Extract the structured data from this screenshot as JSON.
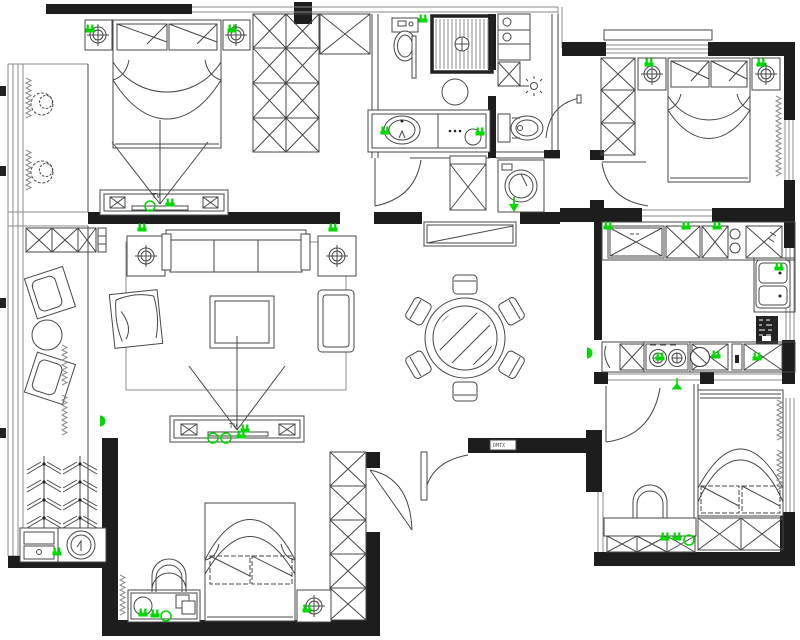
{
  "document": {
    "kind": "apartment-floor-plan",
    "style": "cad-line-drawing"
  },
  "labels": {
    "tv": "TV",
    "entry_wall_tag": "DMTX"
  },
  "colors": {
    "wall": "#1d1d1d",
    "line": "#474747",
    "marker": "#00d900",
    "background": "#ffffff"
  },
  "rooms": [
    {
      "id": "bedroom-top-left"
    },
    {
      "id": "walkin-wardrobe"
    },
    {
      "id": "bathroom-main"
    },
    {
      "id": "bathroom-second"
    },
    {
      "id": "bedroom-top-right"
    },
    {
      "id": "balcony-left"
    },
    {
      "id": "living-room"
    },
    {
      "id": "dining-room"
    },
    {
      "id": "kitchen"
    },
    {
      "id": "laundry-balcony"
    },
    {
      "id": "bedroom-bottom-middle"
    },
    {
      "id": "entry-hall"
    },
    {
      "id": "study-bottom-right"
    },
    {
      "id": "bedroom-bottom-right"
    }
  ],
  "markers": [
    {
      "k": "socket",
      "x": 90,
      "y": 30
    },
    {
      "k": "socket",
      "x": 232,
      "y": 30
    },
    {
      "k": "ring",
      "x": 150,
      "y": 206
    },
    {
      "k": "socket",
      "x": 170,
      "y": 204
    },
    {
      "k": "socket",
      "x": 423,
      "y": 20
    },
    {
      "k": "socket",
      "x": 385,
      "y": 132
    },
    {
      "k": "socket",
      "x": 480,
      "y": 133
    },
    {
      "k": "socket",
      "x": 649,
      "y": 64
    },
    {
      "k": "socket",
      "x": 761,
      "y": 64
    },
    {
      "k": "socket",
      "x": 142,
      "y": 229
    },
    {
      "k": "socket",
      "x": 333,
      "y": 229
    },
    {
      "k": "ring",
      "x": 213,
      "y": 438
    },
    {
      "k": "ring",
      "x": 226,
      "y": 438
    },
    {
      "k": "socket",
      "x": 241,
      "y": 436
    },
    {
      "k": "halfdisc",
      "x": 100,
      "y": 421
    },
    {
      "k": "arrow",
      "x": 514,
      "y": 206
    },
    {
      "k": "socket",
      "x": 608,
      "y": 227
    },
    {
      "k": "socket",
      "x": 686,
      "y": 227
    },
    {
      "k": "socket",
      "x": 717,
      "y": 227
    },
    {
      "k": "socket",
      "x": 779,
      "y": 268
    },
    {
      "k": "socket",
      "x": 660,
      "y": 358
    },
    {
      "k": "socket",
      "x": 716,
      "y": 356
    },
    {
      "k": "socket",
      "x": 757,
      "y": 358
    },
    {
      "k": "halfdisc",
      "x": 587,
      "y": 353
    },
    {
      "k": "pendant",
      "x": 677,
      "y": 388
    },
    {
      "k": "socket",
      "x": 57,
      "y": 553
    },
    {
      "k": "socket",
      "x": 143,
      "y": 614
    },
    {
      "k": "socket",
      "x": 155,
      "y": 615
    },
    {
      "k": "ring",
      "x": 166,
      "y": 616
    },
    {
      "k": "socket",
      "x": 307,
      "y": 610
    },
    {
      "k": "socket",
      "x": 665,
      "y": 538
    },
    {
      "k": "socket",
      "x": 677,
      "y": 538
    },
    {
      "k": "ring",
      "x": 689,
      "y": 540
    },
    {
      "k": "socket",
      "x": 245,
      "y": 430
    }
  ]
}
